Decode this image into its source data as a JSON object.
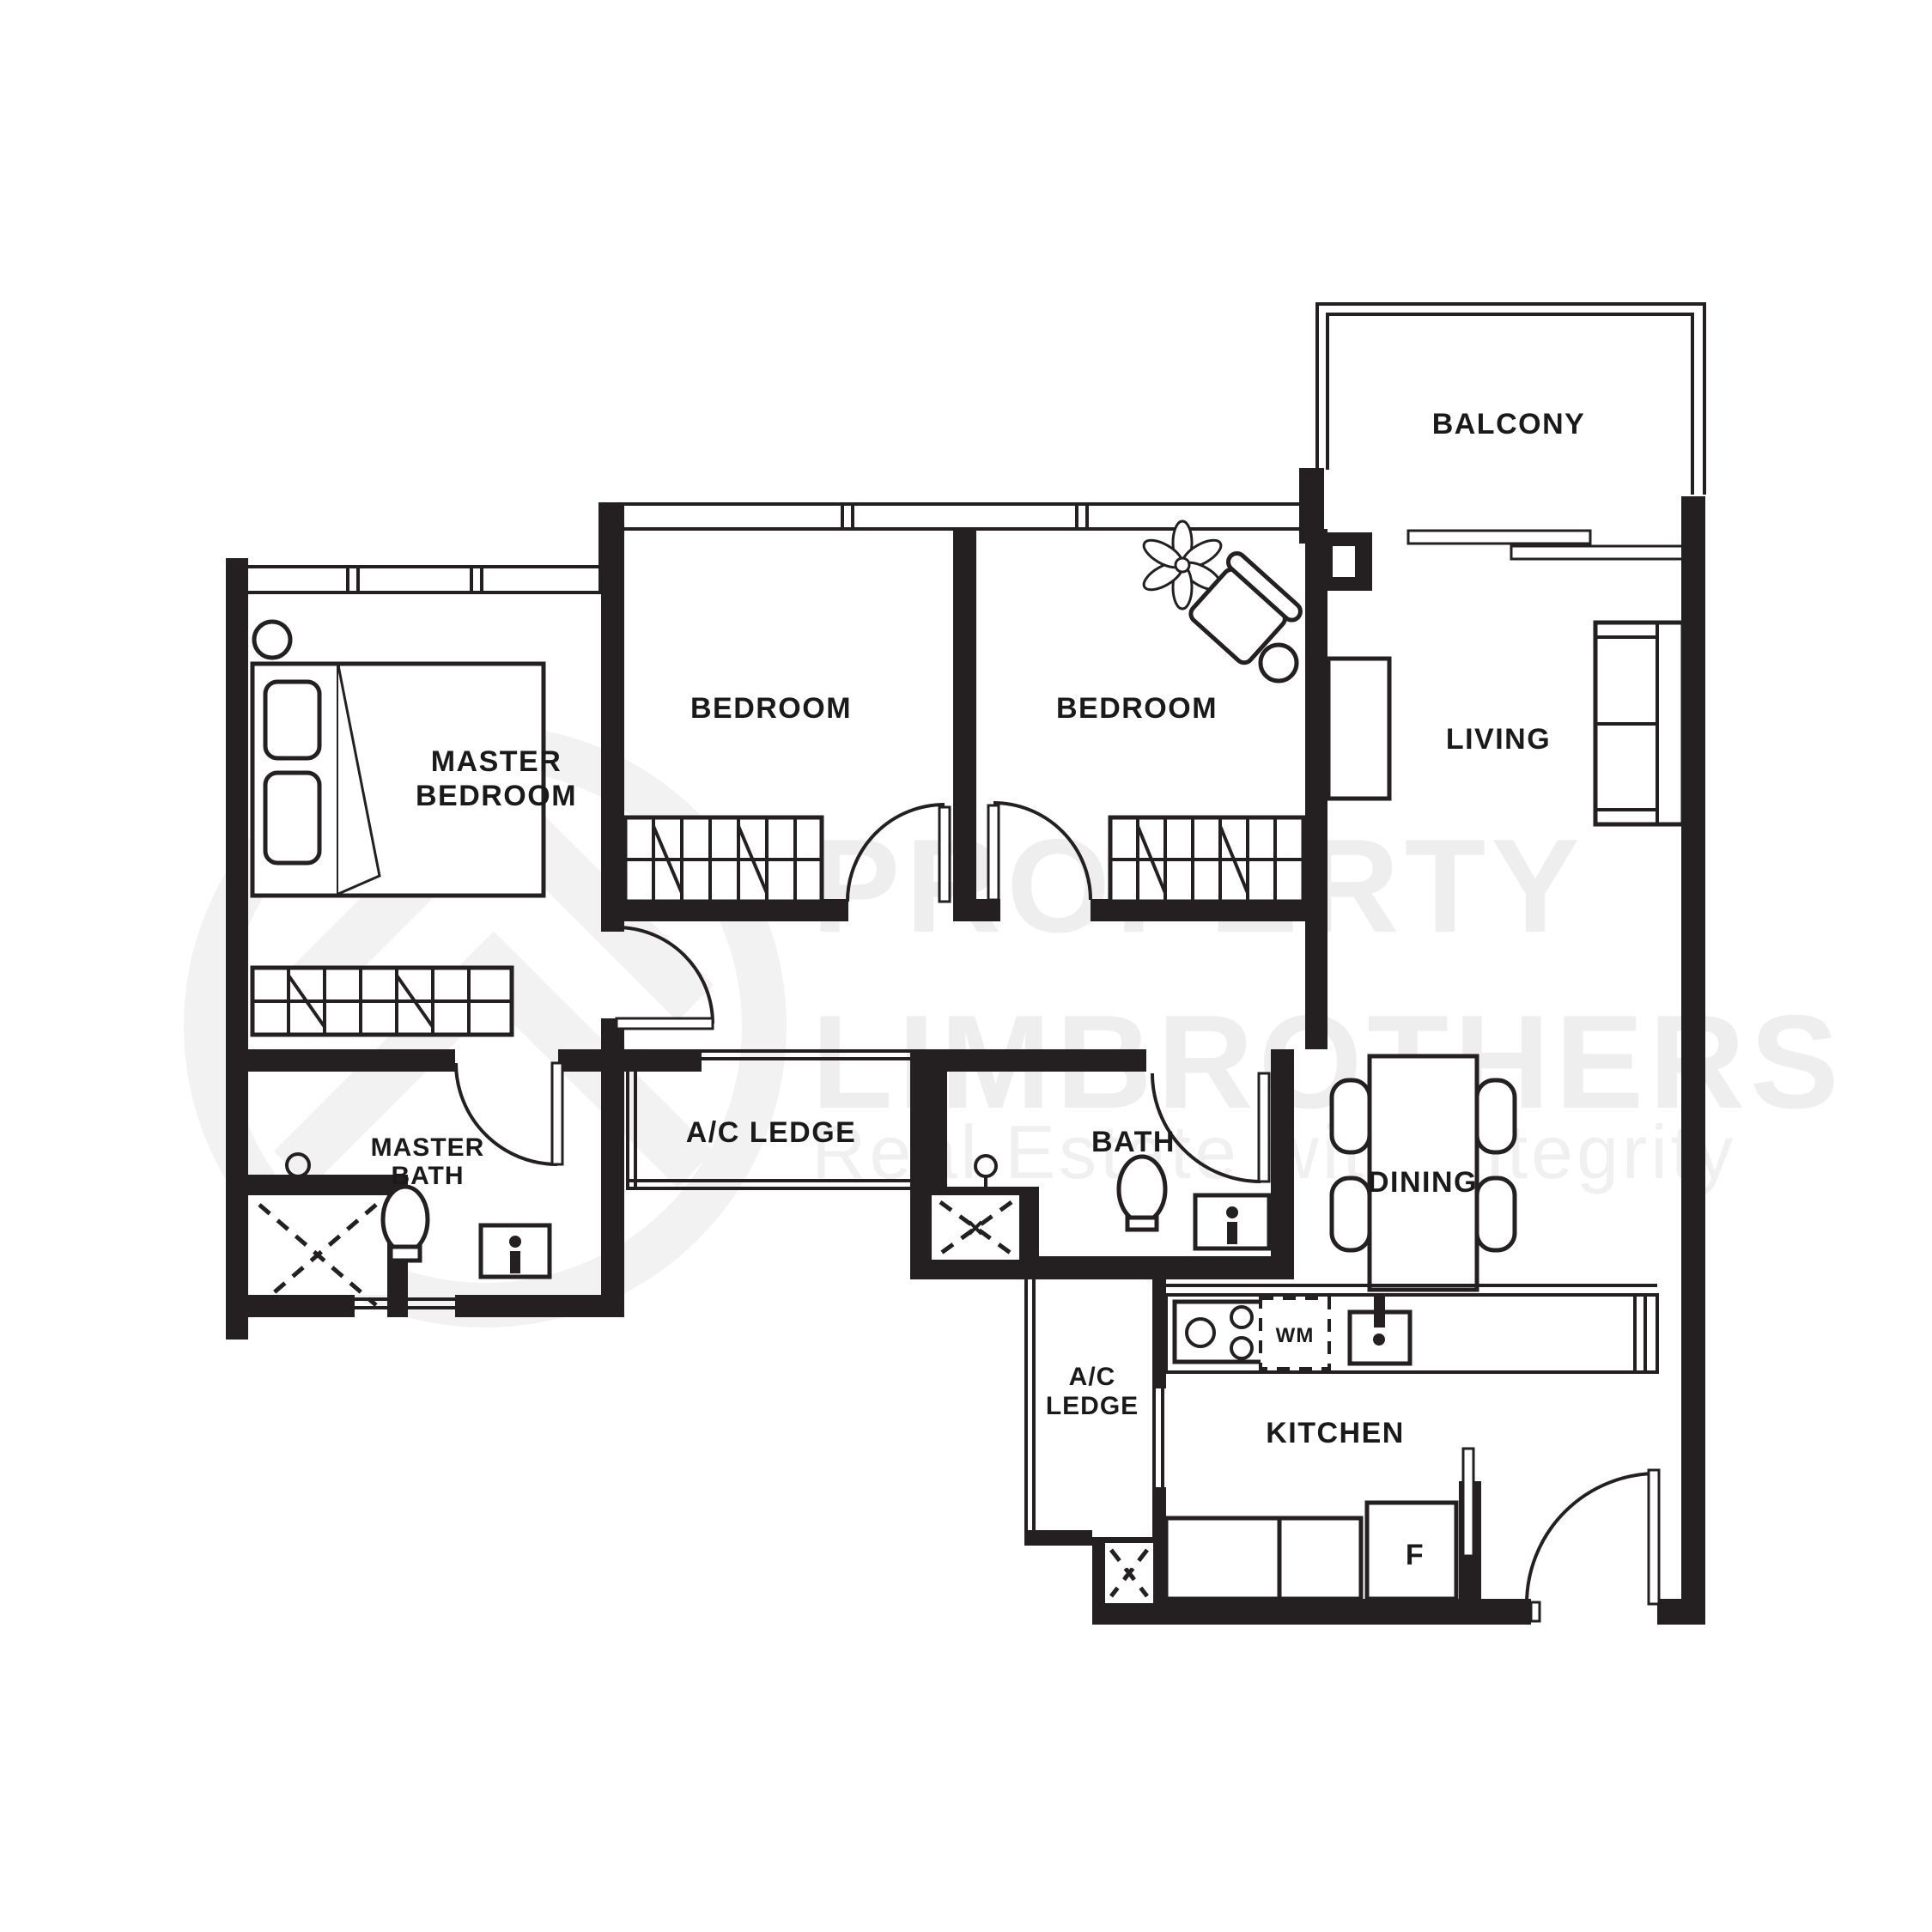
{
  "watermark": {
    "line1": "PROPERTY",
    "line2": "LIMBROTHERS",
    "tagline": "Real Estate with Integrity"
  },
  "rooms": {
    "balcony": {
      "label": "BALCONY"
    },
    "living": {
      "label": "LIVING"
    },
    "bedroom_1": {
      "label": "BEDROOM"
    },
    "bedroom_2": {
      "label": "BEDROOM"
    },
    "master_bedroom": {
      "line1": "MASTER",
      "line2": "BEDROOM"
    },
    "master_bath": {
      "line1": "MASTER",
      "line2": "BATH"
    },
    "ac_ledge_upper": {
      "label": "A/C LEDGE"
    },
    "bath": {
      "label": "BATH"
    },
    "dining": {
      "label": "DINING"
    },
    "kitchen": {
      "label": "KITCHEN"
    },
    "ac_ledge_lower": {
      "line1": "A/C",
      "line2": "LEDGE"
    }
  },
  "appliances": {
    "washing_machine": "WM",
    "fridge": "F"
  },
  "colors": {
    "wall": "#241f21",
    "label": "#1a1a1a",
    "watermark": "#eeeeee",
    "background": "#ffffff"
  }
}
